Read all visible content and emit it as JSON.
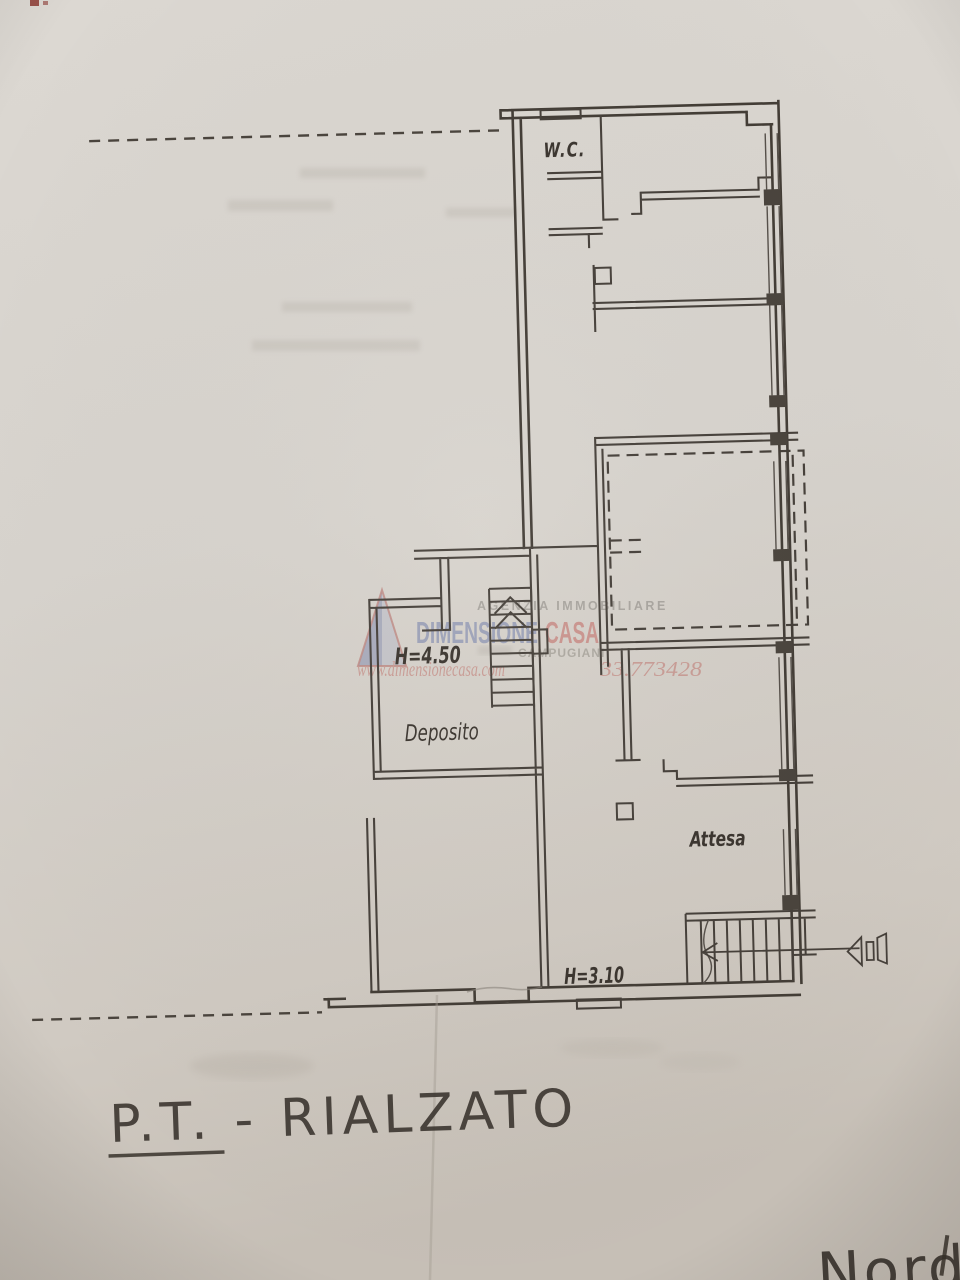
{
  "plan_labels": {
    "wc": "W.C.",
    "height_upper": "H=4.50",
    "deposito": "Deposito",
    "attesa": "Attesa",
    "height_lower": "H=3.10"
  },
  "handwriting": {
    "floor_title": "P.T. - RIALZATO",
    "corner_note_partial": "Nord"
  },
  "watermark": {
    "agency_type": "AGENZIA IMMOBILIARE",
    "brand_word1": "DIMENSIONE",
    "brand_word2": "CASA",
    "subtitle_partial": "CAMPUGIANI",
    "website": "www.dimensionecasa.com",
    "phone_partial": "33.773428"
  },
  "colors": {
    "paper": "#d8d3cc",
    "ink": "#433d36",
    "watermark_blue": "#7b86ae",
    "watermark_red": "#c4706b",
    "pencil": "#3a342e"
  }
}
